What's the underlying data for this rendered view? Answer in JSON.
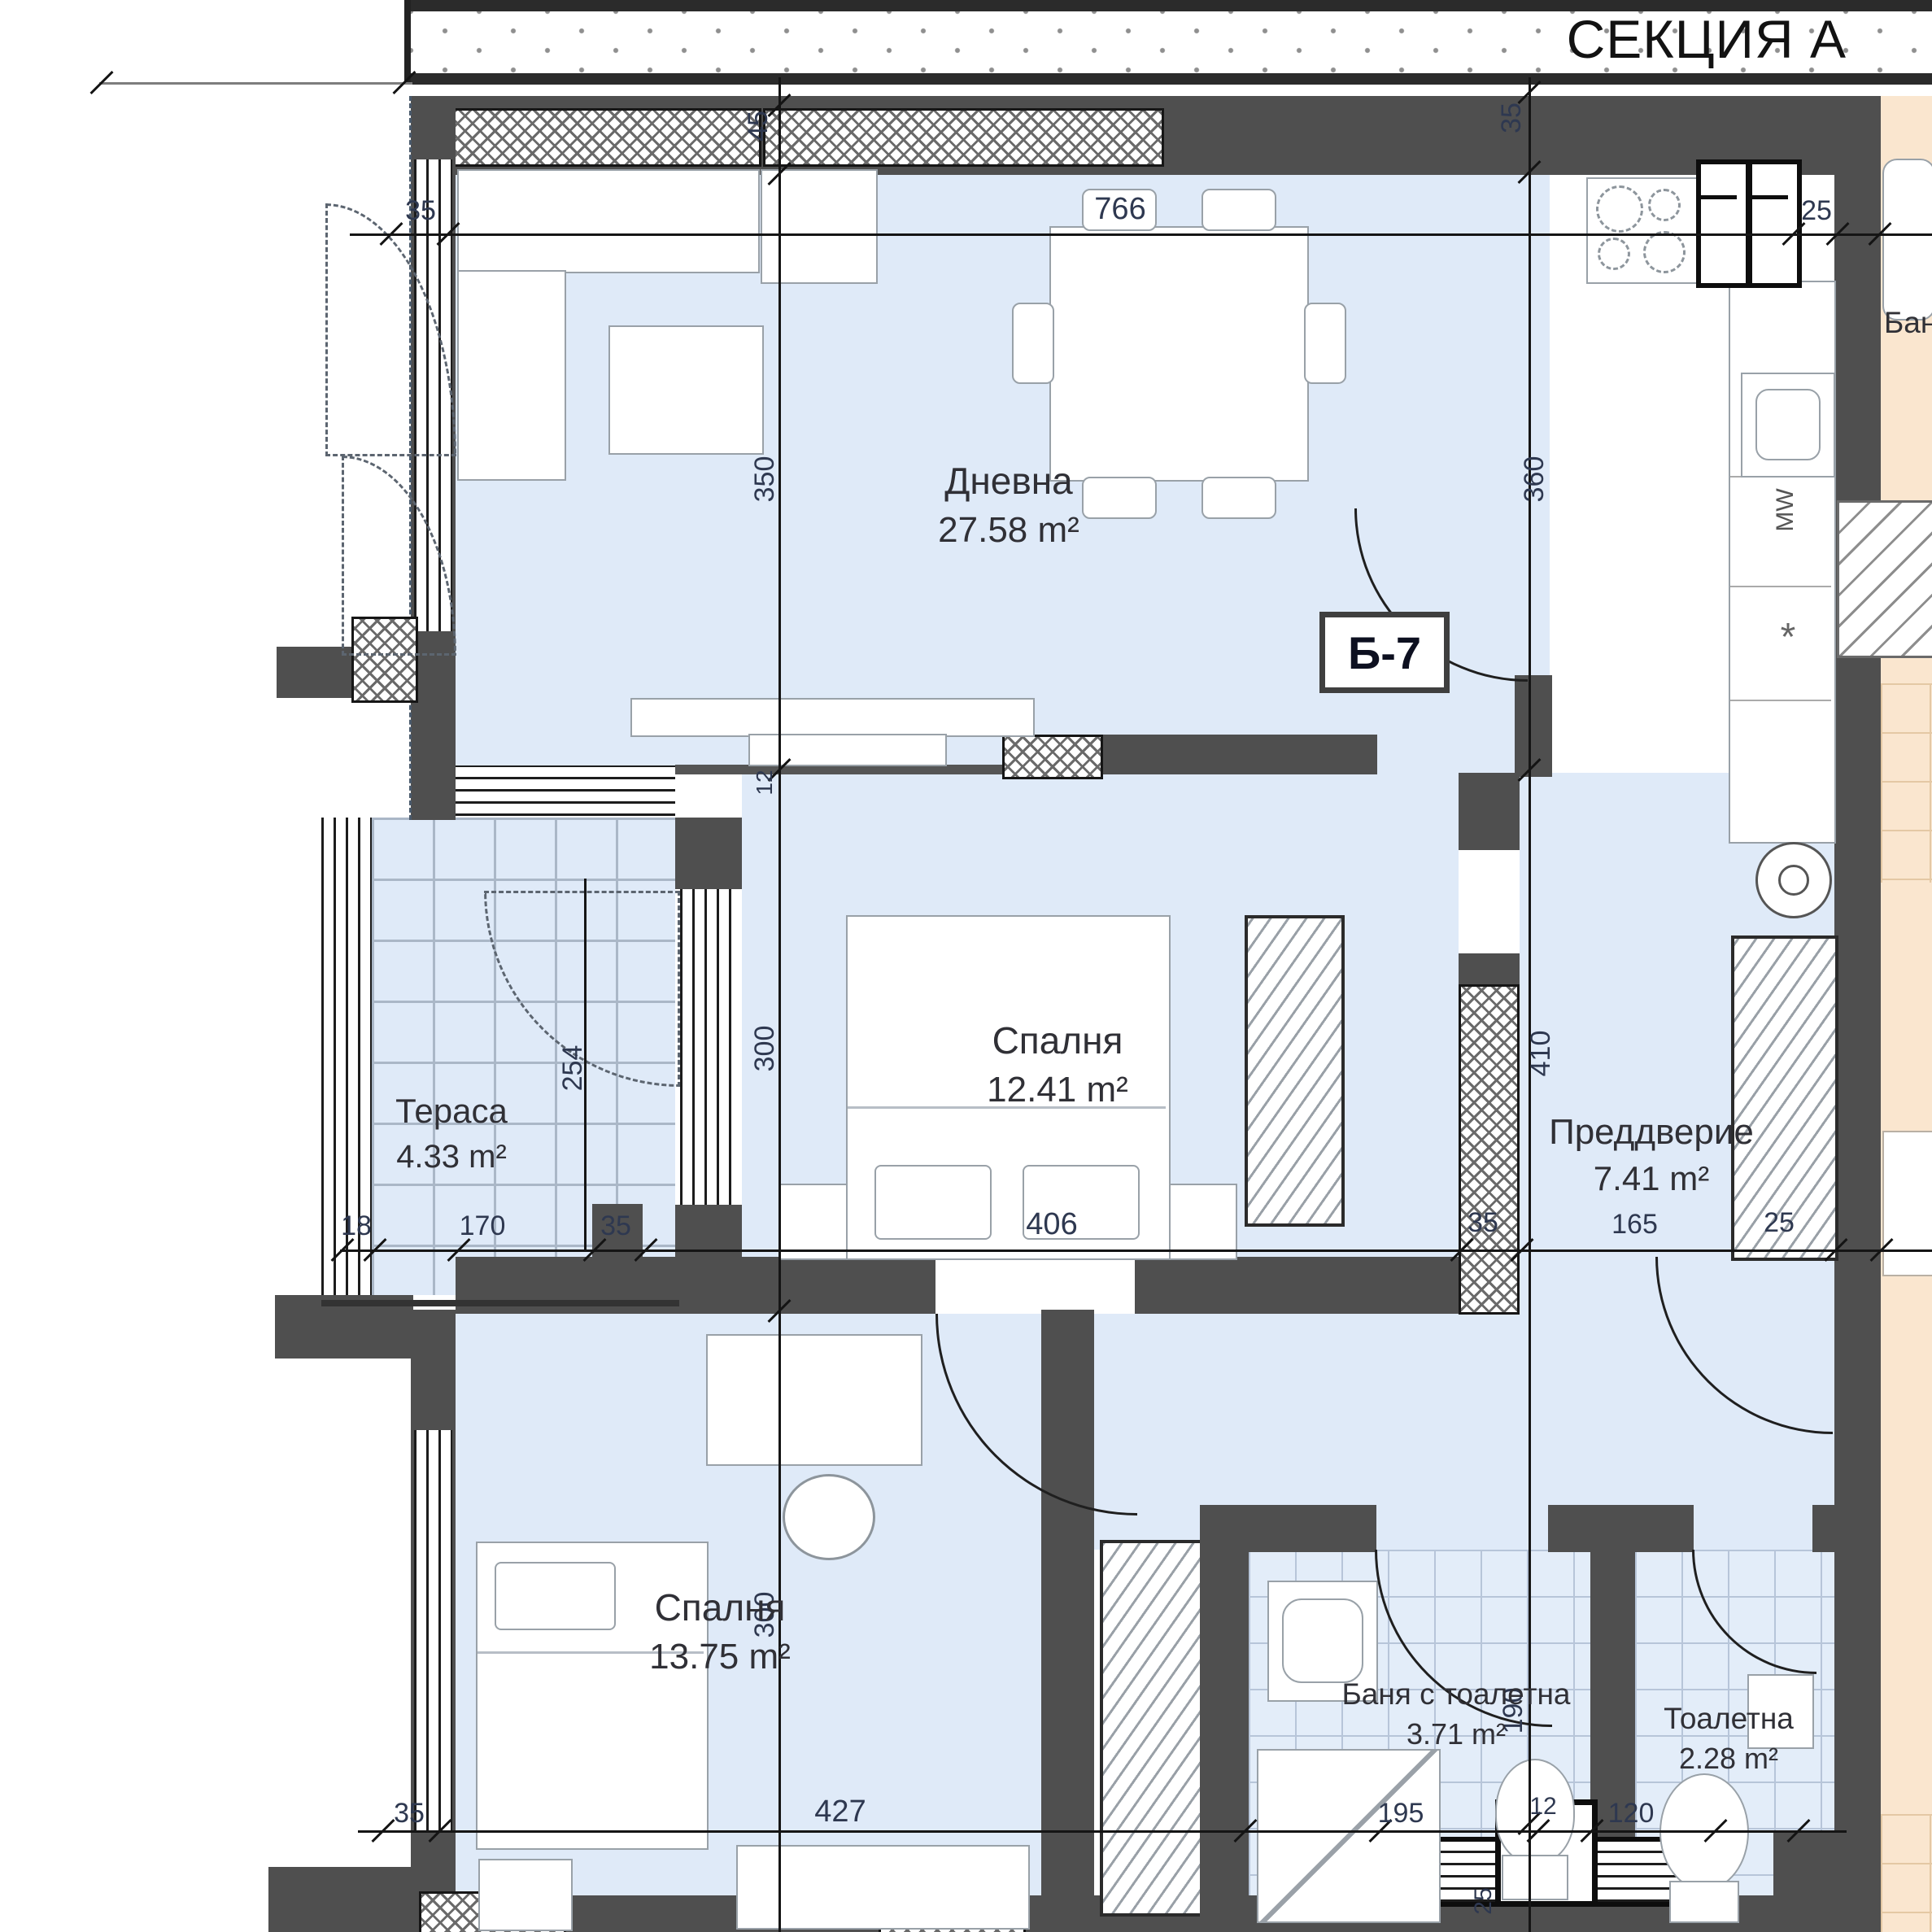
{
  "header": {
    "section_title": "СЕКЦИЯ А"
  },
  "unit": {
    "code": "Б-7"
  },
  "rooms": {
    "living": {
      "name": "Дневна",
      "area": "27.58 m²"
    },
    "bedroom1": {
      "name": "Спалня",
      "area": "12.41 m²"
    },
    "terrace": {
      "name": "Тераса",
      "area": "4.33 m²"
    },
    "hallway": {
      "name": "Преддверие",
      "area": "7.41 m²"
    },
    "bedroom2": {
      "name": "Спалня",
      "area": "13.75 m²"
    },
    "bathroom": {
      "name": "Баня с тоалетна",
      "area": "3.71 m²"
    },
    "toilet": {
      "name": "Тоалетна",
      "area": "2.28 m²"
    },
    "neighbor": {
      "name": "Баня"
    }
  },
  "appliances": {
    "microwave": "MW",
    "dishwasher_star": "*"
  },
  "dims": {
    "top": {
      "a": "35",
      "b": "766",
      "c": "25"
    },
    "mid": {
      "a": "18",
      "b": "170",
      "c": "35",
      "d": "406",
      "e": "35",
      "f": "165",
      "g": "25"
    },
    "bot": {
      "a": "35",
      "b": "427",
      "c": "195",
      "d": "12",
      "e": "120"
    },
    "left": {
      "a": "45",
      "b": "350",
      "c": "12",
      "d": "300",
      "e": "300"
    },
    "right": {
      "a": "35",
      "b": "360",
      "c": "410",
      "d": "190",
      "e": "25"
    },
    "terrace": {
      "a": "254"
    }
  },
  "colors": {
    "wall": "#4f4f4f",
    "room_fill": "#dfeaf8",
    "neighbor_fill": "#fae6cf",
    "line": "#151515",
    "dim_text": "#2e3850",
    "label_text": "#303036"
  }
}
